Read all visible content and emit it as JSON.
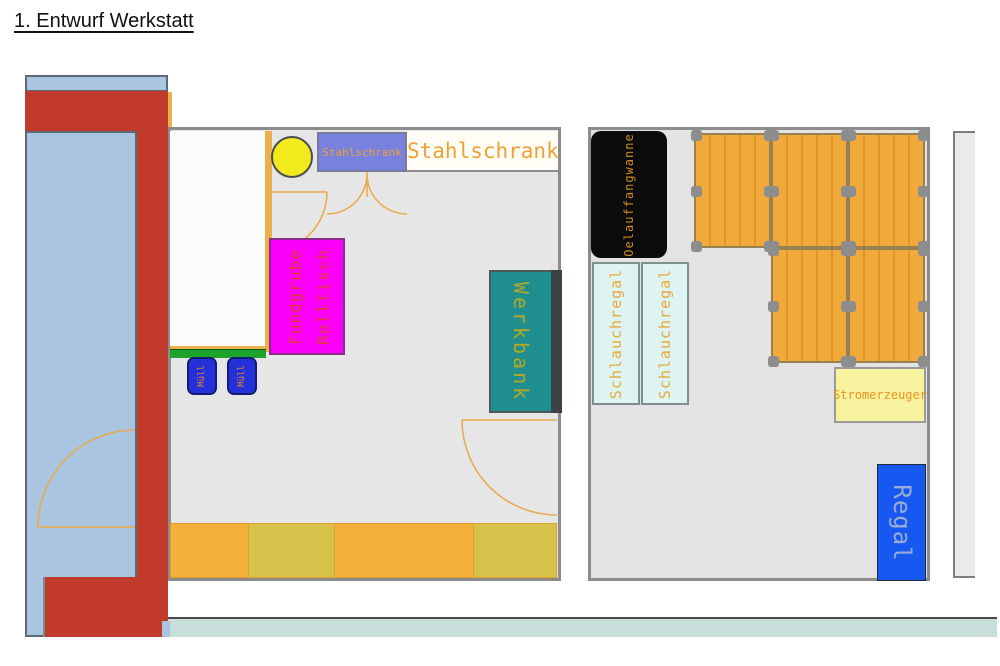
{
  "title": "1. Entwurf Werkstatt",
  "rooms": {
    "left": {
      "steel_cabinet_box": "Stahlschrank",
      "steel_cabinet_text": "Stahlschrank",
      "pit_table_line1": "Fundgrube",
      "pit_table_line2": "Rolltisch",
      "trash_1": "Müll",
      "trash_2": "Müll",
      "workbench": "Werkbank"
    },
    "right": {
      "oil_pan": "Oelauffangwanne",
      "hose_rack_1": "Schlauchregal",
      "hose_rack_2": "Schlauchregal",
      "generator": "Stromerzeuger",
      "shelf": "Regal"
    }
  },
  "colors": {
    "red": "#c23a2b",
    "lightblue": "#a9c5df",
    "blueborder": "#5c6a78",
    "roomfill": "#e6e6e6",
    "roomfill2": "#e3e3e3",
    "wall": "#8c8c8c",
    "orangeline": "#eab049",
    "labelorange": "#efa133",
    "cabblue": "#7781de",
    "circleyellow": "#f2ea1d",
    "magenta": "#fa00fa",
    "green": "#1ea32a",
    "binblue": "#2431d8",
    "teal": "#1f8e8e",
    "bandorange": "#f3b13c",
    "bandolive": "#d9c24b",
    "cyanbox": "#def4f3",
    "tableorange": "#f1a93c",
    "tablestripe": "#dd9626",
    "foot": "#8d8d8d",
    "genyellow": "#f6f29d",
    "regalblue": "#1758f0",
    "bottomband": "#c9dedb",
    "doorarc": "#e8a94a"
  }
}
